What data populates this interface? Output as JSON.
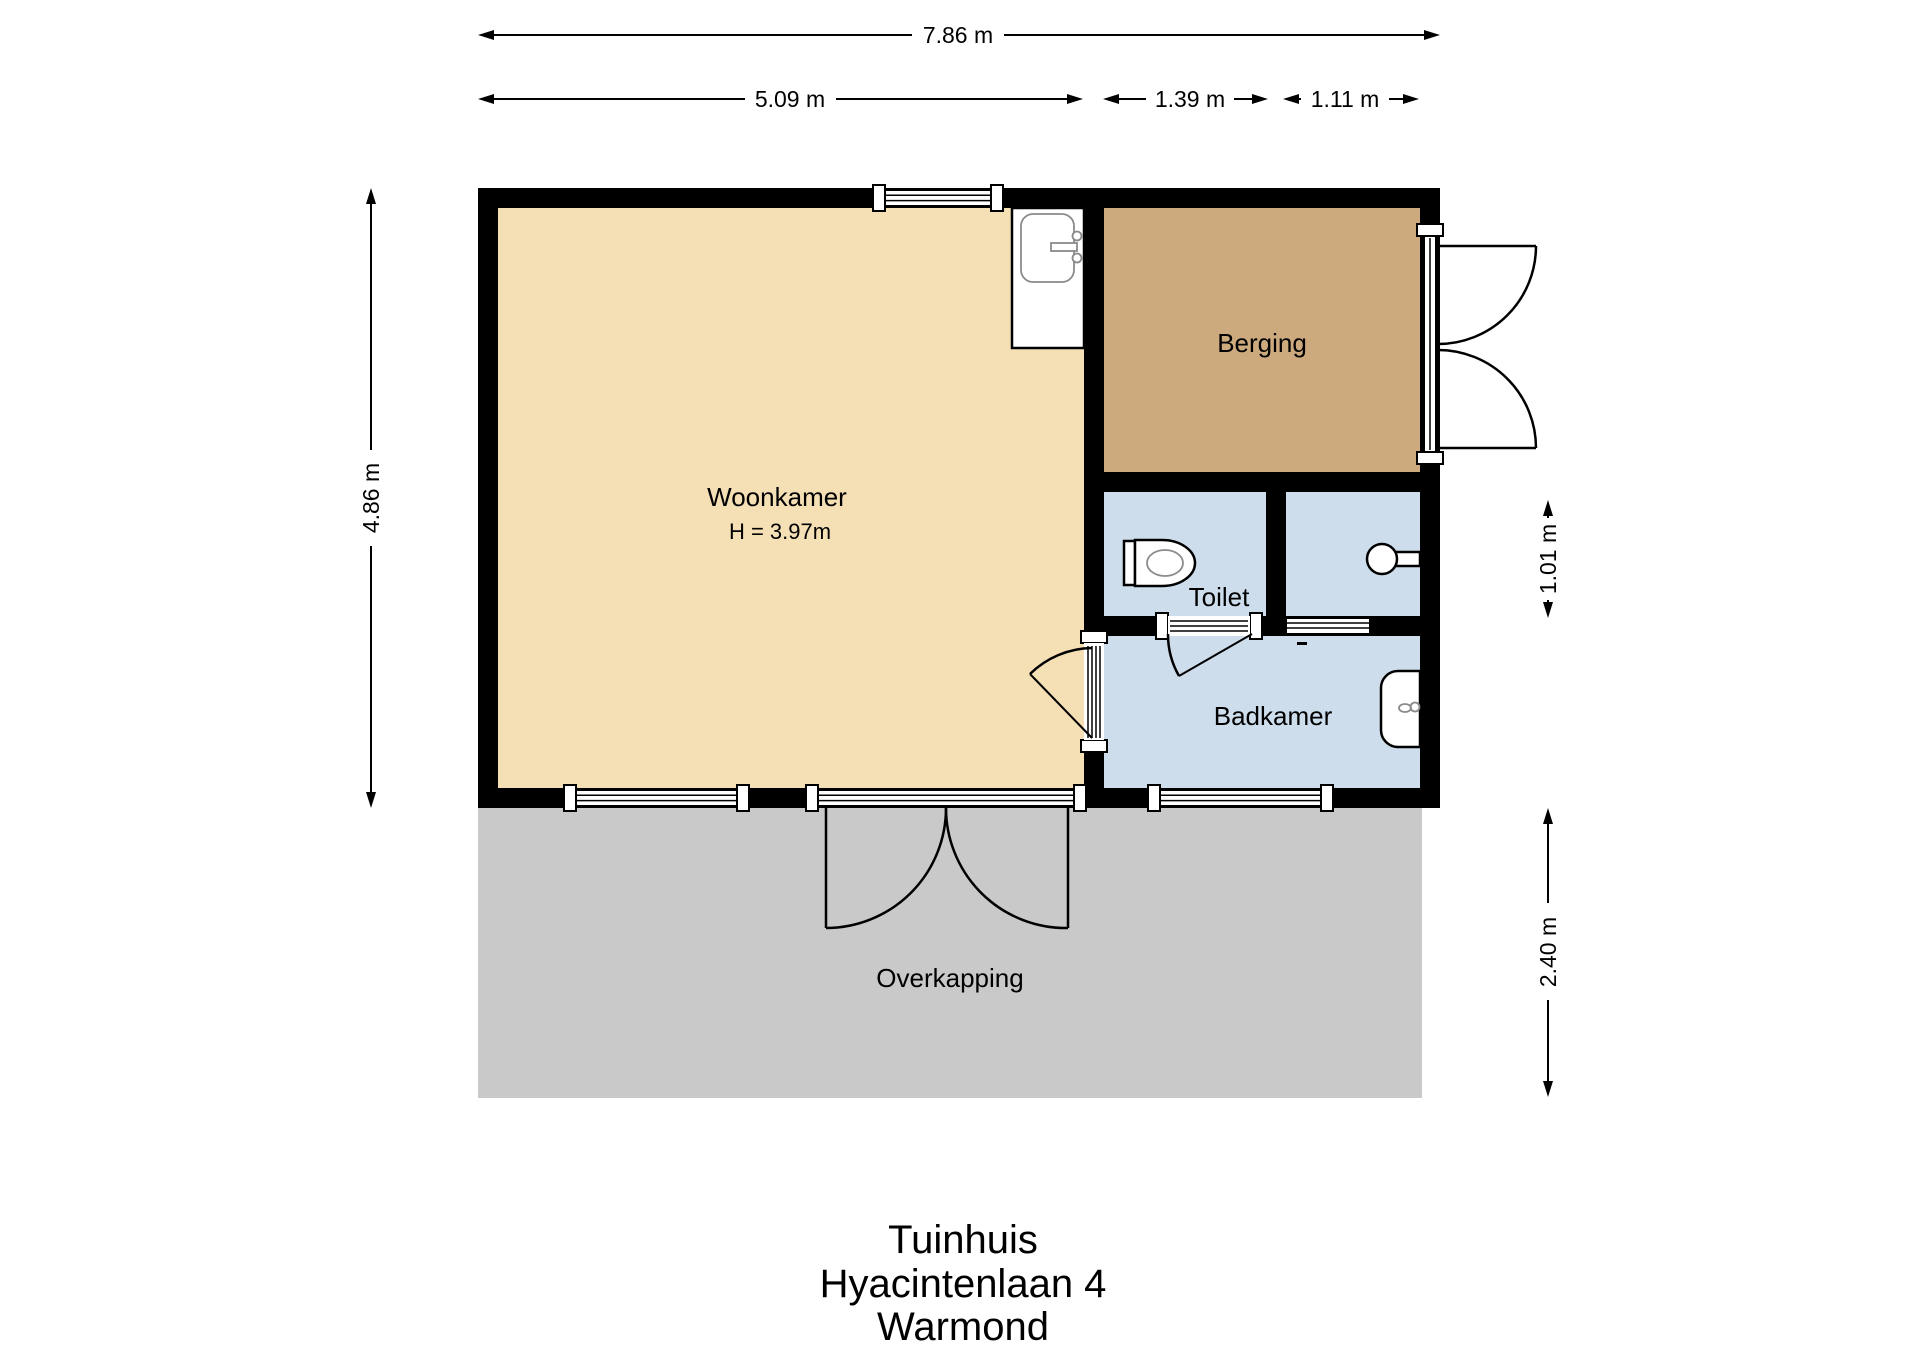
{
  "plan": {
    "rooms": {
      "woonkamer": {
        "label": "Woonkamer",
        "height_note": "H = 3.97m"
      },
      "berging": {
        "label": "Berging"
      },
      "toilet": {
        "label": "Toilet"
      },
      "badkamer": {
        "label": "Badkamer"
      },
      "overkapping": {
        "label": "Overkapping"
      }
    },
    "dimensions": {
      "total_width": "7.86 m",
      "woonkamer_width": "5.09 m",
      "toilet_width": "1.39 m",
      "shower_width": "1.11 m",
      "building_height": "4.86 m",
      "sanitary_height": "1.01 m",
      "overkapping_depth": "2.40 m"
    }
  },
  "title": {
    "building": "Tuinhuis",
    "address": "Hyacintenlaan 4",
    "city": "Warmond"
  },
  "colors": {
    "wall": "#000000",
    "line": "#000000",
    "woonkamer": "#f5dfb5",
    "berging": "#cdaa7e",
    "sanitary": "#cdddec",
    "overkapping": "#c9c9c9"
  }
}
